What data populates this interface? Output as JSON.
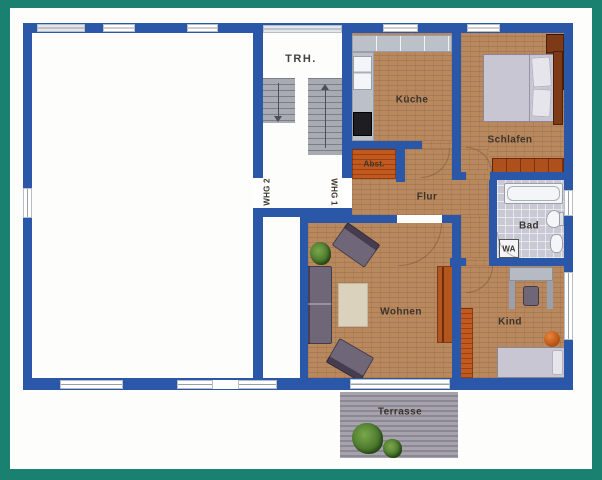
{
  "floorplan": {
    "type": "apartment-floor-plan",
    "stairwell": {
      "label": "TRH."
    },
    "apartment_doors": {
      "whg2": {
        "label": "WHG 2"
      },
      "whg1": {
        "label": "WHG 1"
      }
    },
    "rooms": {
      "kueche": {
        "label": "Küche"
      },
      "schlafen": {
        "label": "Schlafen"
      },
      "abstellraum": {
        "label": "Abst."
      },
      "flur": {
        "label": "Flur"
      },
      "bad": {
        "label": "Bad"
      },
      "wohnen": {
        "label": "Wohnen"
      },
      "kind": {
        "label": "Kind"
      },
      "terrasse": {
        "label": "Terrasse"
      }
    },
    "fixtures": {
      "washing_machine": {
        "label": "WA"
      }
    },
    "colors": {
      "frame_teal": "#1a8070",
      "wall_blue": "#2b57a8",
      "floor_wood": "#b8885e",
      "floor_tile_bad": "#c9c9d5",
      "terrace_gray": "#99959f",
      "stairs_gray": "#a8abb2",
      "shelf_orange": "#c25a1f",
      "furniture_gray_violet": "#6f6678",
      "wood_dark": "#7c3a17",
      "paper_white": "#fdfdfc"
    }
  }
}
